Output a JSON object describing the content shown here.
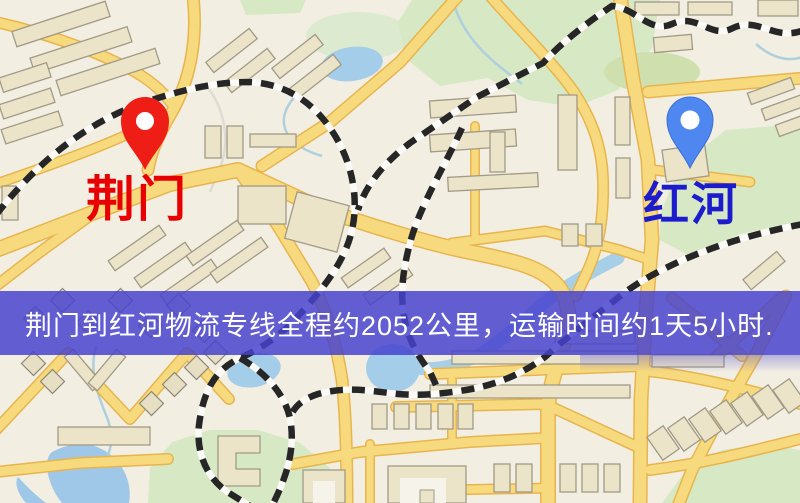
{
  "map": {
    "origin": {
      "label": "荆门",
      "label_color": "#e80000",
      "marker_color": "#ee1d16",
      "marker": "red-pin"
    },
    "destination": {
      "label": "红河",
      "label_color": "#1c1ccd",
      "marker_color": "#4d87ef",
      "marker": "blue-pin"
    }
  },
  "banner": {
    "text": "荆门到红河物流专线全程约2052公里，运输时间约1天5小时.",
    "background_color": "#4d4acd",
    "text_color": "#ffffff",
    "distance_km": "2052",
    "duration_text": "1天5小时"
  }
}
